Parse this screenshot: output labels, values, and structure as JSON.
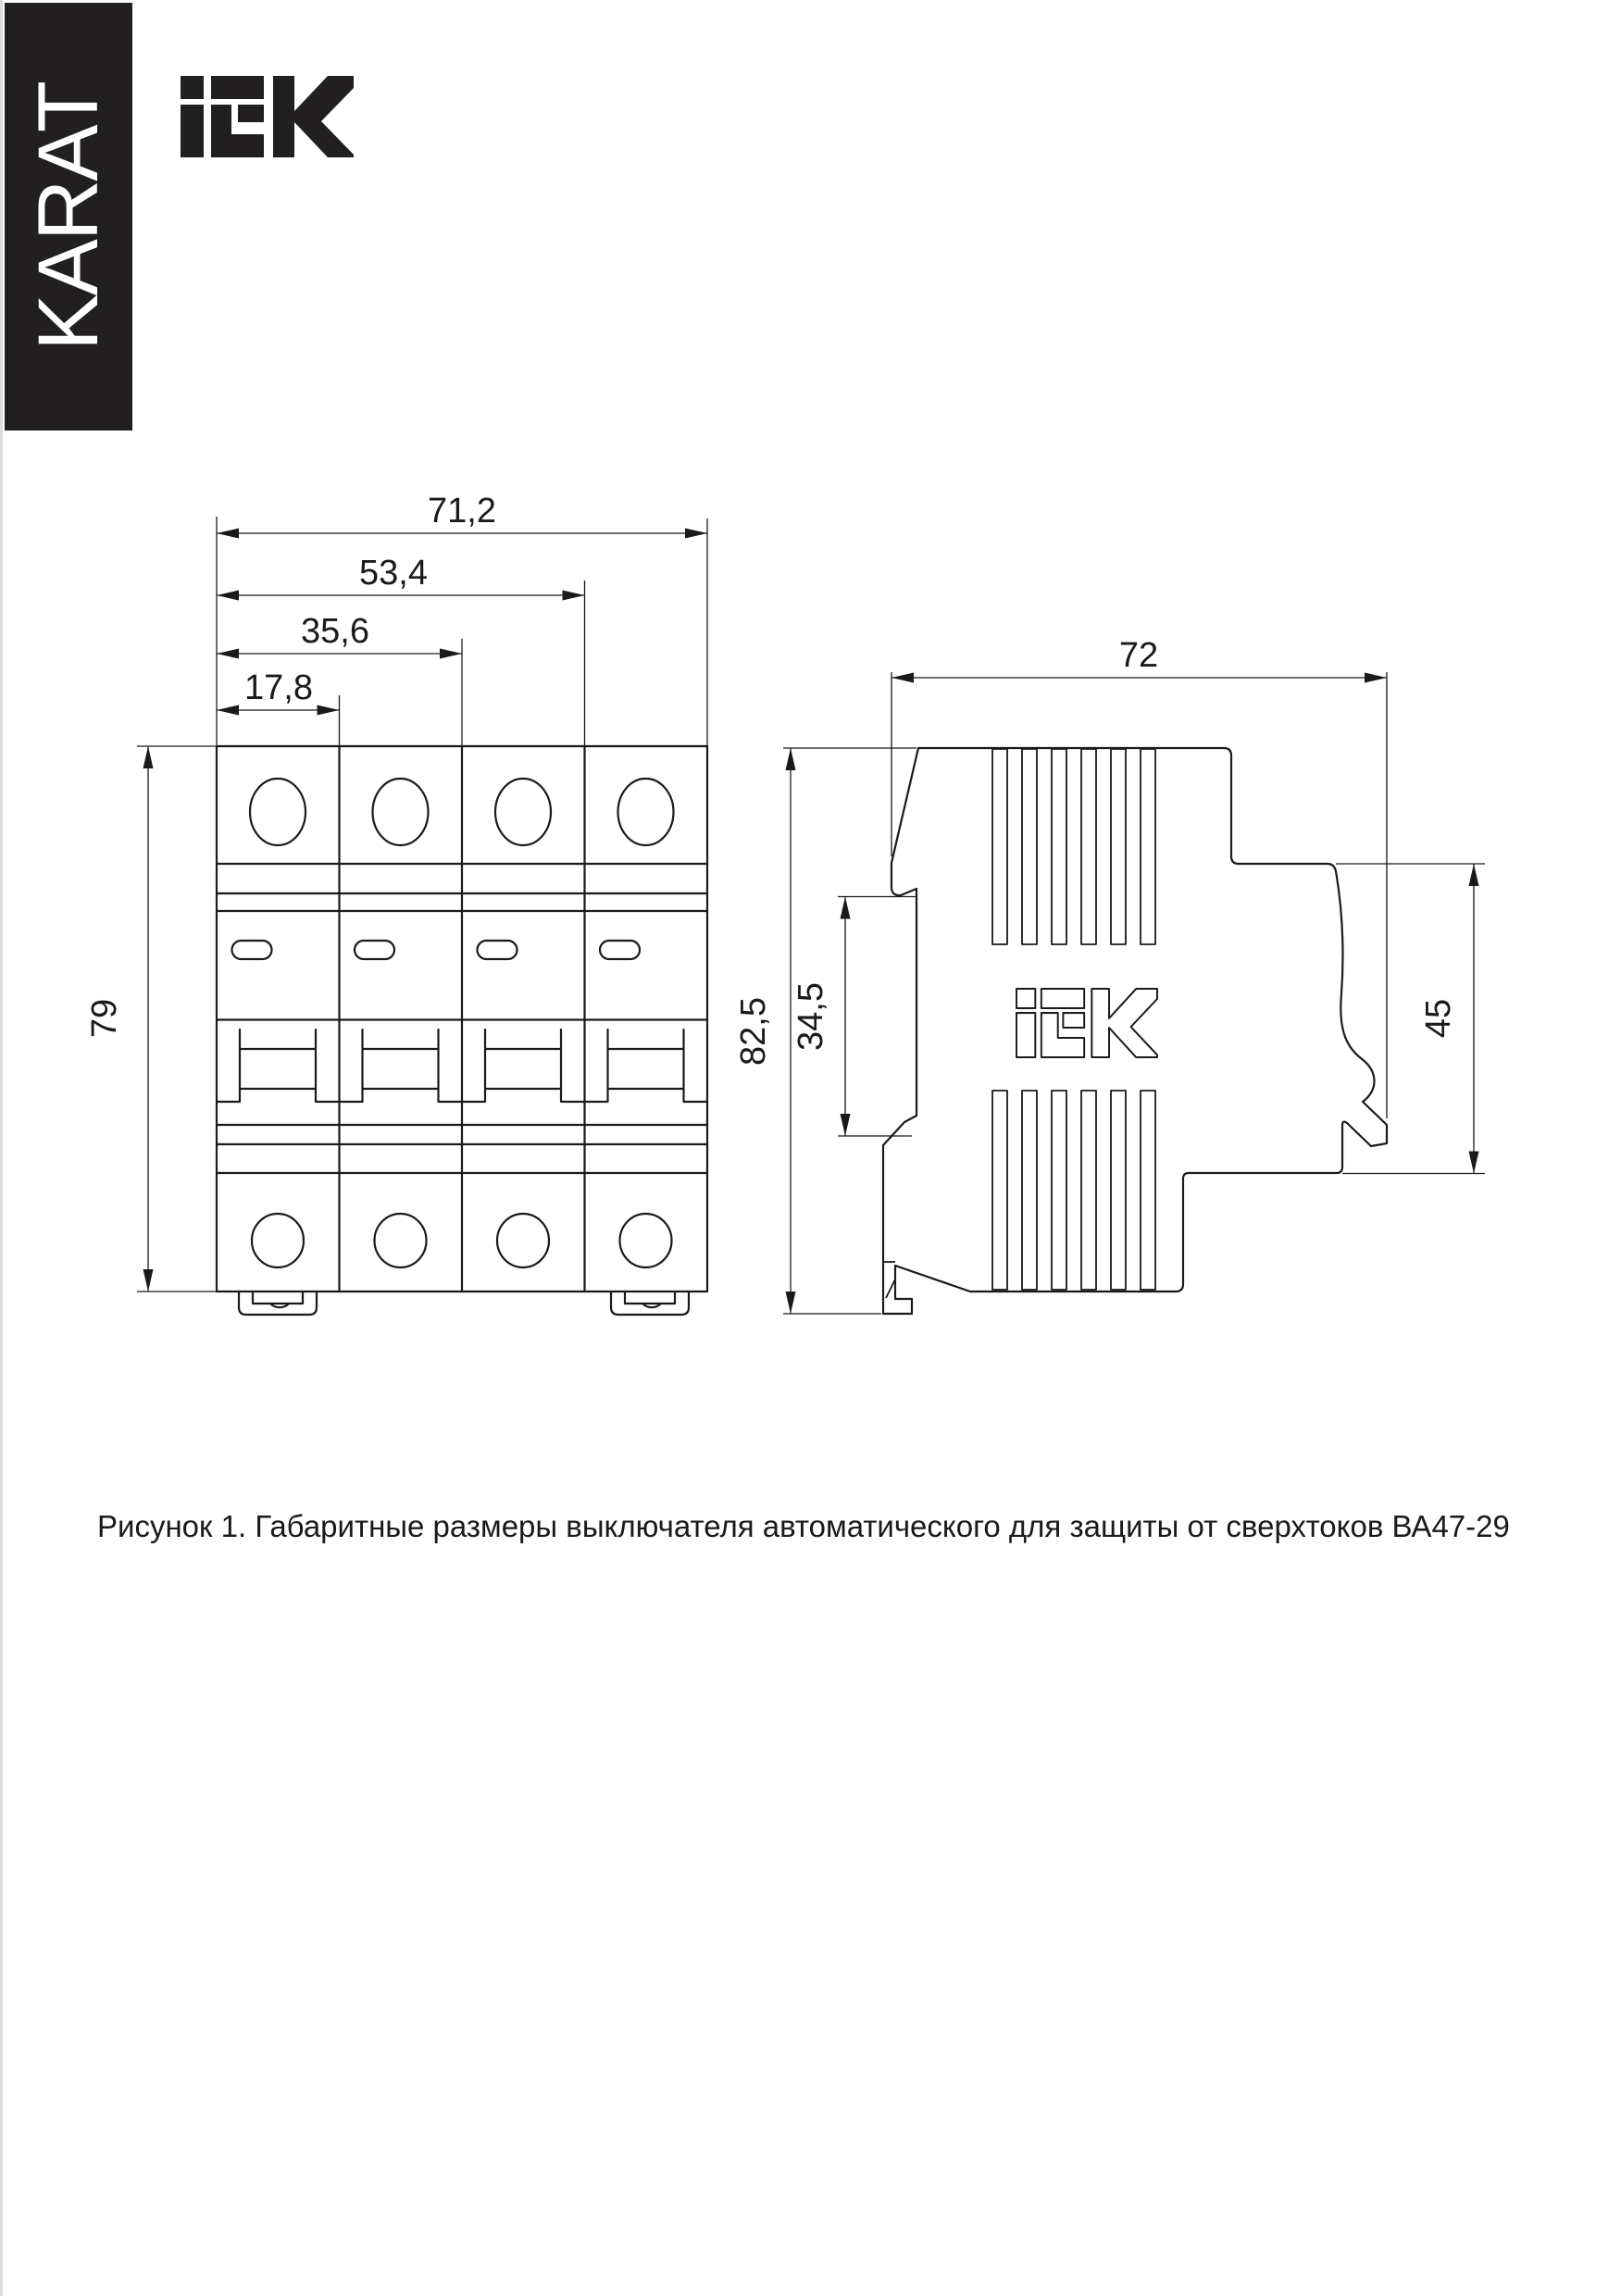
{
  "branding": {
    "karat_banner": "KARAT",
    "iek_logo": "IEK",
    "side_view_logo": "IEK"
  },
  "front_view": {
    "width_total": "71,2",
    "width_three_pole": "53,4",
    "width_two_pole": "35,6",
    "width_one_pole": "17,8",
    "height": "79"
  },
  "side_view": {
    "depth": "72",
    "height_total": "82,5",
    "din_channel_height": "34,5",
    "terminal_height": "45"
  },
  "caption": "Рисунок 1. Габаритные размеры выключателя автоматического для защиты от сверхтоков ВА47-29"
}
